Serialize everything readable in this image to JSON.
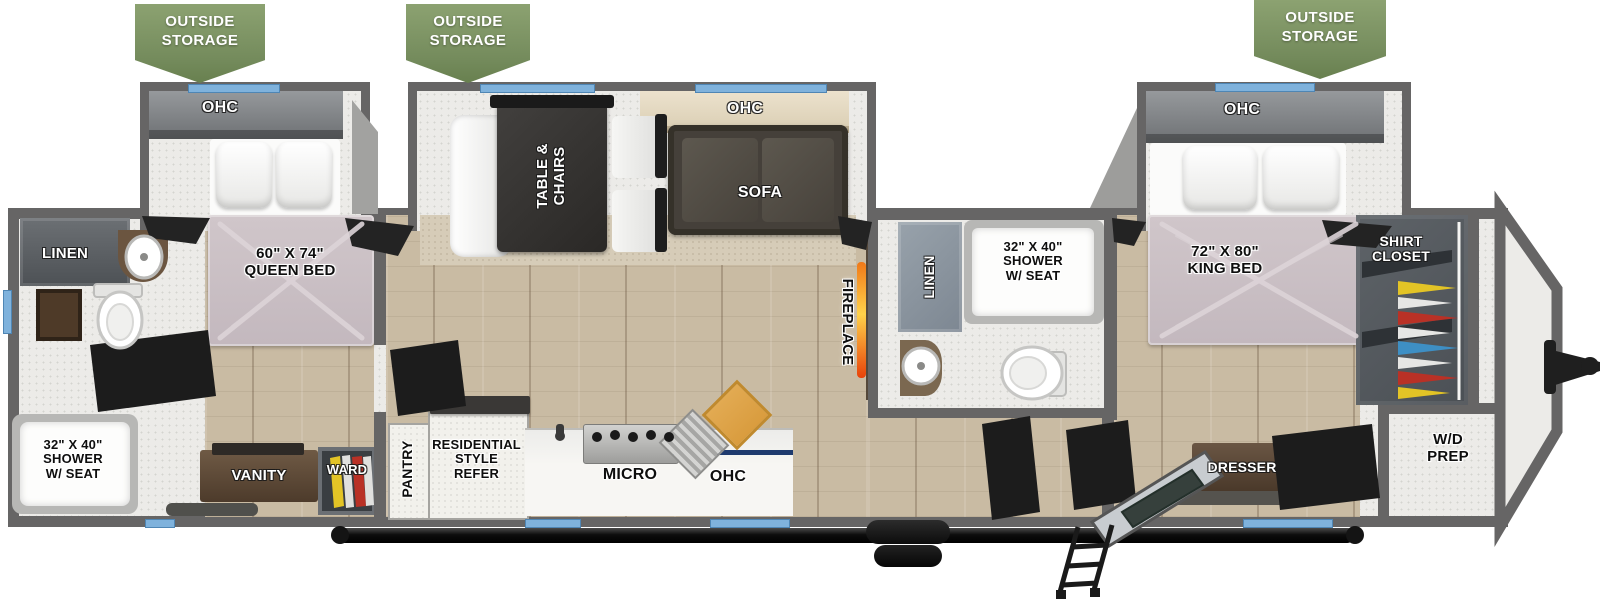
{
  "banners": {
    "b1": "OUTSIDE\nSTORAGE",
    "b2": "OUTSIDE\nSTORAGE",
    "b3": "OUTSIDE\nSTORAGE"
  },
  "rear_bedroom": {
    "ohc": "OHC",
    "bed": "60\" X 74\"\nQUEEN BED"
  },
  "rear_bath": {
    "linen": "LINEN",
    "shower": "32\" X 40\"\nSHOWER\nW/ SEAT",
    "vanity": "VANITY",
    "wardrobe": "WARD"
  },
  "living": {
    "ohc": "OHC",
    "table": "TABLE &\nCHAIRS",
    "sofa": "SOFA",
    "fireplace": "FIREPLACE"
  },
  "kitchen": {
    "pantry": "PANTRY",
    "refrigerator": "RESIDENTIAL\nSTYLE\nREFER",
    "microwave": "MICRO",
    "ohc": "OHC"
  },
  "mid_bath": {
    "linen": "LINEN",
    "shower": "32\" X 40\"\nSHOWER\nW/ SEAT"
  },
  "front_bedroom": {
    "ohc": "OHC",
    "bed": "72\" X 80\"\nKING BED",
    "dresser": "DRESSER",
    "shirt_closet": "SHIRT\nCLOSET"
  },
  "utility": {
    "wd_prep": "W/D\nPREP"
  },
  "colors": {
    "banner_green": "#7A9160",
    "window_blue": "#7FB2DC",
    "wall_gray": "#666565",
    "mattress_mauve": "#C9BEC4",
    "flame_orange": "#F07818",
    "wood_floor": "#C9BBA3"
  }
}
